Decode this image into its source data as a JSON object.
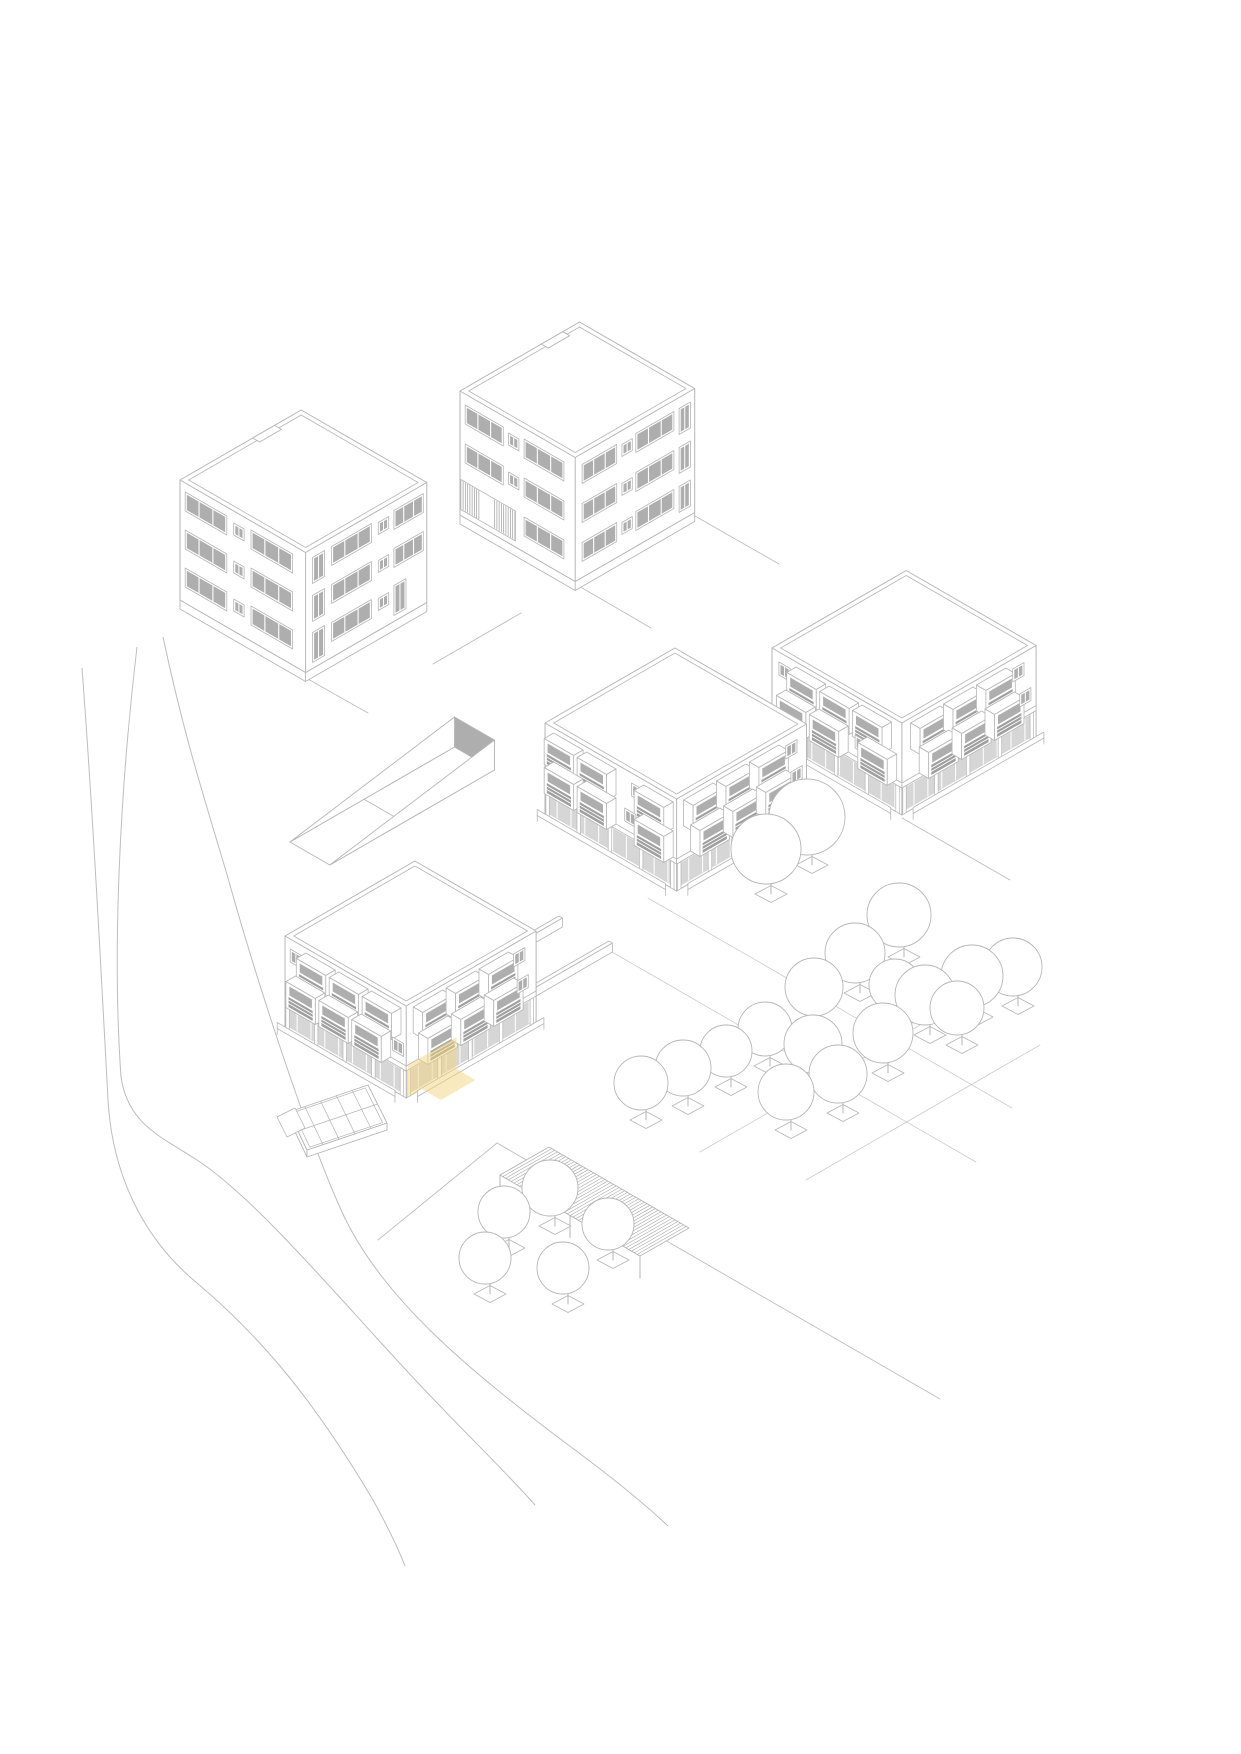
{
  "meta": {
    "title": "Axonometric site diagram – five residential blocks with highlighted ground-floor unit",
    "canvas": {
      "width": 1241,
      "height": 1754
    },
    "background": "#ffffff"
  },
  "style": {
    "line": "#b6b6b6",
    "line_soft": "#cccccc",
    "road_line": "#bdbdbd",
    "glass": "#aeaeae",
    "rail": "#9f9f9f",
    "white": "#ffffff",
    "hatch": "#a9a9a9",
    "highlight": "#f3d57f",
    "highlight_opacity": 0.5,
    "stroke_width": 0.9
  },
  "scene": {
    "road": {
      "curves": [
        "M163,637 C185,740 205,800 228,878 C255,975 305,1130 342,1212 C380,1295 462,1366 575,1450 C618,1482 648,1507 668,1526",
        "M137,647 C120,790 112,950 121,1077 C128,1124 160,1136 197,1160 C258,1200 340,1300 420,1385 C468,1436 506,1472 535,1505",
        "M82,668 C92,800 100,950 108,1100 C112,1170 140,1236 197,1283 C250,1328 305,1385 373,1500 C388,1527 398,1548 405,1566"
      ]
    },
    "paths": {
      "segments": [
        [
          306,
          678,
          368,
          713
        ],
        [
          433,
          664,
          521,
          613
        ],
        [
          577,
          585,
          651,
          628
        ],
        [
          695,
          516,
          779,
          564
        ],
        [
          378,
          1240,
          497,
          1143
        ],
        [
          497,
          1143,
          940,
          1399
        ],
        [
          902,
          818,
          1010,
          880
        ]
      ]
    },
    "orchard_grid": [
      [
        648,
        898,
        1012,
        1108
      ],
      [
        612,
        952,
        976,
        1162
      ],
      [
        806,
        1180,
        1040,
        1045
      ],
      [
        700,
        1152,
        934,
        1017
      ]
    ],
    "ramp": {
      "start": [
        290,
        842
      ],
      "length": 190,
      "width": 46,
      "end_wall_height": 30,
      "crease_t": 0.45
    },
    "greenhouse": {
      "outline": [
        [
          368,
          1085
        ],
        [
          387,
          1123
        ],
        [
          307,
          1150
        ],
        [
          289,
          1112
        ]
      ],
      "inset": 3,
      "crossbar_ts": [
        0.2,
        0.4,
        0.6,
        0.8
      ],
      "drop": 7,
      "end_box": [
        [
          277,
          1117
        ],
        [
          295,
          1108
        ],
        [
          305,
          1128
        ],
        [
          287,
          1137
        ]
      ]
    },
    "pergola": {
      "corners": [
        [
          549,
          1147
        ],
        [
          689,
          1228
        ],
        [
          640,
          1256
        ],
        [
          500,
          1175
        ]
      ],
      "hatch_step": 3.2,
      "post_height": 22
    },
    "walls": [
      {
        "start": [
          455,
          985
        ],
        "length": 120,
        "height": 9,
        "thick": 4
      },
      {
        "start": [
          505,
          1010
        ],
        "length": 120,
        "height": 9,
        "thick": 4
      },
      {
        "start": [
          747,
          843
        ],
        "length": 88,
        "height": 9,
        "thick": 4
      }
    ],
    "buildings": [
      {
        "id": "tower-northwest",
        "kind": "tower",
        "origin": [
          180,
          600
        ],
        "w": 145,
        "d": 140,
        "h": 120,
        "parapet_inset": 5,
        "plinth": 9,
        "floor_base": 4,
        "story": 38,
        "floors": 3,
        "notch": {
          "t0": 0.6,
          "t1": 0.78,
          "depth": 8
        },
        "sw": [
          {
            "t": "band",
            "u": 6,
            "w": 48,
            "dz": 12,
            "h": 19
          },
          {
            "t": "sq",
            "u": 62,
            "w": 12,
            "dz": 16,
            "h": 12
          },
          {
            "t": "band",
            "u": 82,
            "w": 48,
            "dz": 12,
            "h": 19
          }
        ],
        "se": [
          {
            "t": "tall",
            "u": 8,
            "w": 14,
            "dz": 5,
            "h": 26
          },
          {
            "t": "band",
            "u": 30,
            "w": 46,
            "dz": 12,
            "h": 19
          },
          {
            "t": "sq",
            "u": 84,
            "w": 12,
            "dz": 16,
            "h": 12
          },
          {
            "t": "band",
            "u": 102,
            "w": 34,
            "dz": 12,
            "h": 19
          }
        ],
        "se_ground": [
          {
            "t": "door",
            "u": 8,
            "w": 14,
            "dz": 2,
            "h": 30
          },
          {
            "t": "band",
            "u": 30,
            "w": 46,
            "dz": 12,
            "h": 19
          },
          {
            "t": "sq",
            "u": 84,
            "w": 12,
            "dz": 16,
            "h": 12
          },
          {
            "t": "door",
            "u": 102,
            "w": 14,
            "dz": 2,
            "h": 30
          }
        ]
      },
      {
        "id": "tower-north",
        "kind": "tower",
        "origin": [
          460,
          515
        ],
        "w": 133,
        "d": 138,
        "h": 124,
        "parapet_inset": 5,
        "plinth": 9,
        "floor_base": 4,
        "story": 39,
        "floors": 3,
        "notch": {
          "t0": 0.68,
          "t1": 0.86,
          "depth": 8
        },
        "sw": [
          {
            "t": "band",
            "u": 6,
            "w": 44,
            "dz": 12,
            "h": 19
          },
          {
            "t": "sq",
            "u": 56,
            "w": 12,
            "dz": 16,
            "h": 12
          },
          {
            "t": "band",
            "u": 74,
            "w": 46,
            "dz": 12,
            "h": 19
          }
        ],
        "sw_ground": [
          {
            "t": "slats",
            "u": 0,
            "w": 64,
            "dz": 2,
            "h": 30,
            "gap0": 24,
            "gap1": 38
          },
          {
            "t": "band",
            "u": 74,
            "w": 46,
            "dz": 12,
            "h": 19
          }
        ],
        "se": [
          {
            "t": "band",
            "u": 8,
            "w": 40,
            "dz": 12,
            "h": 19
          },
          {
            "t": "sq",
            "u": 54,
            "w": 12,
            "dz": 16,
            "h": 12
          },
          {
            "t": "band",
            "u": 70,
            "w": 44,
            "dz": 12,
            "h": 19
          },
          {
            "t": "tall",
            "u": 120,
            "w": 13,
            "dz": 5,
            "h": 26
          }
        ]
      },
      {
        "id": "block-middle",
        "kind": "balcony",
        "origin": [
          545,
          815
        ],
        "w": 152,
        "d": 150,
        "h": 92,
        "parapet_inset": 5,
        "rows_sw": [
          {
            "z": 61,
            "items": [
              {
                "t": "mod",
                "u": 10
              },
              {
                "t": "mod",
                "u": 48
              },
              {
                "t": "sq",
                "u": 100,
                "dz": 8
              },
              {
                "t": "mod",
                "u": 114
              }
            ]
          },
          {
            "z": 32,
            "items": [
              {
                "t": "mod",
                "u": 10
              },
              {
                "t": "mod",
                "u": 48
              },
              {
                "t": "sq",
                "u": 92,
                "dz": 8
              },
              {
                "t": "mod",
                "u": 114
              }
            ]
          }
        ],
        "rows_se": [
          {
            "z": 61,
            "items": [
              {
                "t": "mod",
                "u": 8
              },
              {
                "t": "mod",
                "u": 46
              },
              {
                "t": "mod",
                "u": 84
              },
              {
                "t": "sq",
                "u": 126,
                "dz": 8
              }
            ]
          },
          {
            "z": 32,
            "items": [
              {
                "t": "mod",
                "u": 16
              },
              {
                "t": "mod",
                "u": 54
              },
              {
                "t": "mod",
                "u": 92
              },
              {
                "t": "sq",
                "u": 132,
                "dz": 8
              }
            ]
          }
        ],
        "arcade": {
          "sw": true,
          "se": true
        }
      },
      {
        "id": "block-east",
        "kind": "balcony",
        "origin": [
          772,
          740
        ],
        "w": 150,
        "d": 155,
        "h": 92,
        "parapet_inset": 5,
        "rows_sw": [
          {
            "z": 61,
            "items": [
              {
                "t": "sq",
                "u": 8,
                "dz": 8
              },
              {
                "t": "mod",
                "u": 28
              },
              {
                "t": "mod",
                "u": 66
              },
              {
                "t": "mod",
                "u": 104
              }
            ]
          },
          {
            "z": 32,
            "items": [
              {
                "t": "mod",
                "u": 16
              },
              {
                "t": "mod",
                "u": 54
              },
              {
                "t": "sq",
                "u": 96,
                "dz": 8
              },
              {
                "t": "mod",
                "u": 110
              }
            ]
          }
        ],
        "rows_se": [
          {
            "z": 61,
            "items": [
              {
                "t": "mod",
                "u": 10
              },
              {
                "t": "mod",
                "u": 48
              },
              {
                "t": "mod",
                "u": 86
              },
              {
                "t": "sq",
                "u": 128,
                "dz": 8
              }
            ]
          },
          {
            "z": 32,
            "items": [
              {
                "t": "mod",
                "u": 20
              },
              {
                "t": "mod",
                "u": 58
              },
              {
                "t": "mod",
                "u": 96
              },
              {
                "t": "sq",
                "u": 136,
                "dz": 8
              }
            ]
          }
        ],
        "arcade": {
          "sw": true,
          "se": true
        }
      },
      {
        "id": "block-southwest",
        "kind": "balcony",
        "origin": [
          285,
          1028
        ],
        "w": 140,
        "d": 150,
        "h": 92,
        "parapet_inset": 5,
        "rows_sw": [
          {
            "z": 61,
            "items": [
              {
                "t": "sq",
                "u": 6,
                "dz": 8
              },
              {
                "t": "mod",
                "u": 24
              },
              {
                "t": "mod",
                "u": 62
              },
              {
                "t": "mod",
                "u": 100
              }
            ]
          },
          {
            "z": 32,
            "items": [
              {
                "t": "mod",
                "u": 12
              },
              {
                "t": "mod",
                "u": 50
              },
              {
                "t": "mod",
                "u": 88
              },
              {
                "t": "sq",
                "u": 124,
                "dz": 8
              }
            ]
          }
        ],
        "rows_se": [
          {
            "z": 61,
            "items": [
              {
                "t": "mod",
                "u": 8
              },
              {
                "t": "mod",
                "u": 46
              },
              {
                "t": "mod",
                "u": 84
              },
              {
                "t": "sq",
                "u": 124,
                "dz": 8
              }
            ]
          },
          {
            "z": 32,
            "items": [
              {
                "t": "mod",
                "u": 14
              },
              {
                "t": "mod",
                "u": 52
              },
              {
                "t": "mod",
                "u": 90
              },
              {
                "t": "sq",
                "u": 128,
                "dz": 8
              }
            ]
          }
        ],
        "arcade": {
          "sw": true,
          "se": true
        },
        "highlight": {
          "facade": "se",
          "u0": 2,
          "u1": 58,
          "z0": 0,
          "z1": 32,
          "ground_u0": 18,
          "ground_u1": 58,
          "ground_dx": 19,
          "ground_dy": 11
        }
      }
    ],
    "trees": [
      [
        807,
        817,
        38
      ],
      [
        766,
        849,
        35
      ],
      [
        899,
        915,
        32
      ],
      [
        855,
        953,
        30
      ],
      [
        814,
        987,
        29
      ],
      [
        895,
        985,
        26
      ],
      [
        925,
        995,
        30
      ],
      [
        972,
        976,
        31
      ],
      [
        1013,
        967,
        29
      ],
      [
        957,
        1008,
        27
      ],
      [
        883,
        1033,
        30
      ],
      [
        813,
        1044,
        29
      ],
      [
        765,
        1029,
        27
      ],
      [
        726,
        1051,
        26
      ],
      [
        683,
        1068,
        28
      ],
      [
        641,
        1083,
        27
      ],
      [
        786,
        1092,
        28
      ],
      [
        838,
        1074,
        29
      ],
      [
        550,
        1188,
        28
      ],
      [
        504,
        1212,
        26
      ],
      [
        608,
        1224,
        26
      ],
      [
        485,
        1258,
        26
      ],
      [
        563,
        1268,
        26
      ]
    ],
    "tree_pit": {
      "dx": 5,
      "dy_below_radius": 10,
      "half_w": 16,
      "half_h": 8.5,
      "trunk": 15
    }
  }
}
